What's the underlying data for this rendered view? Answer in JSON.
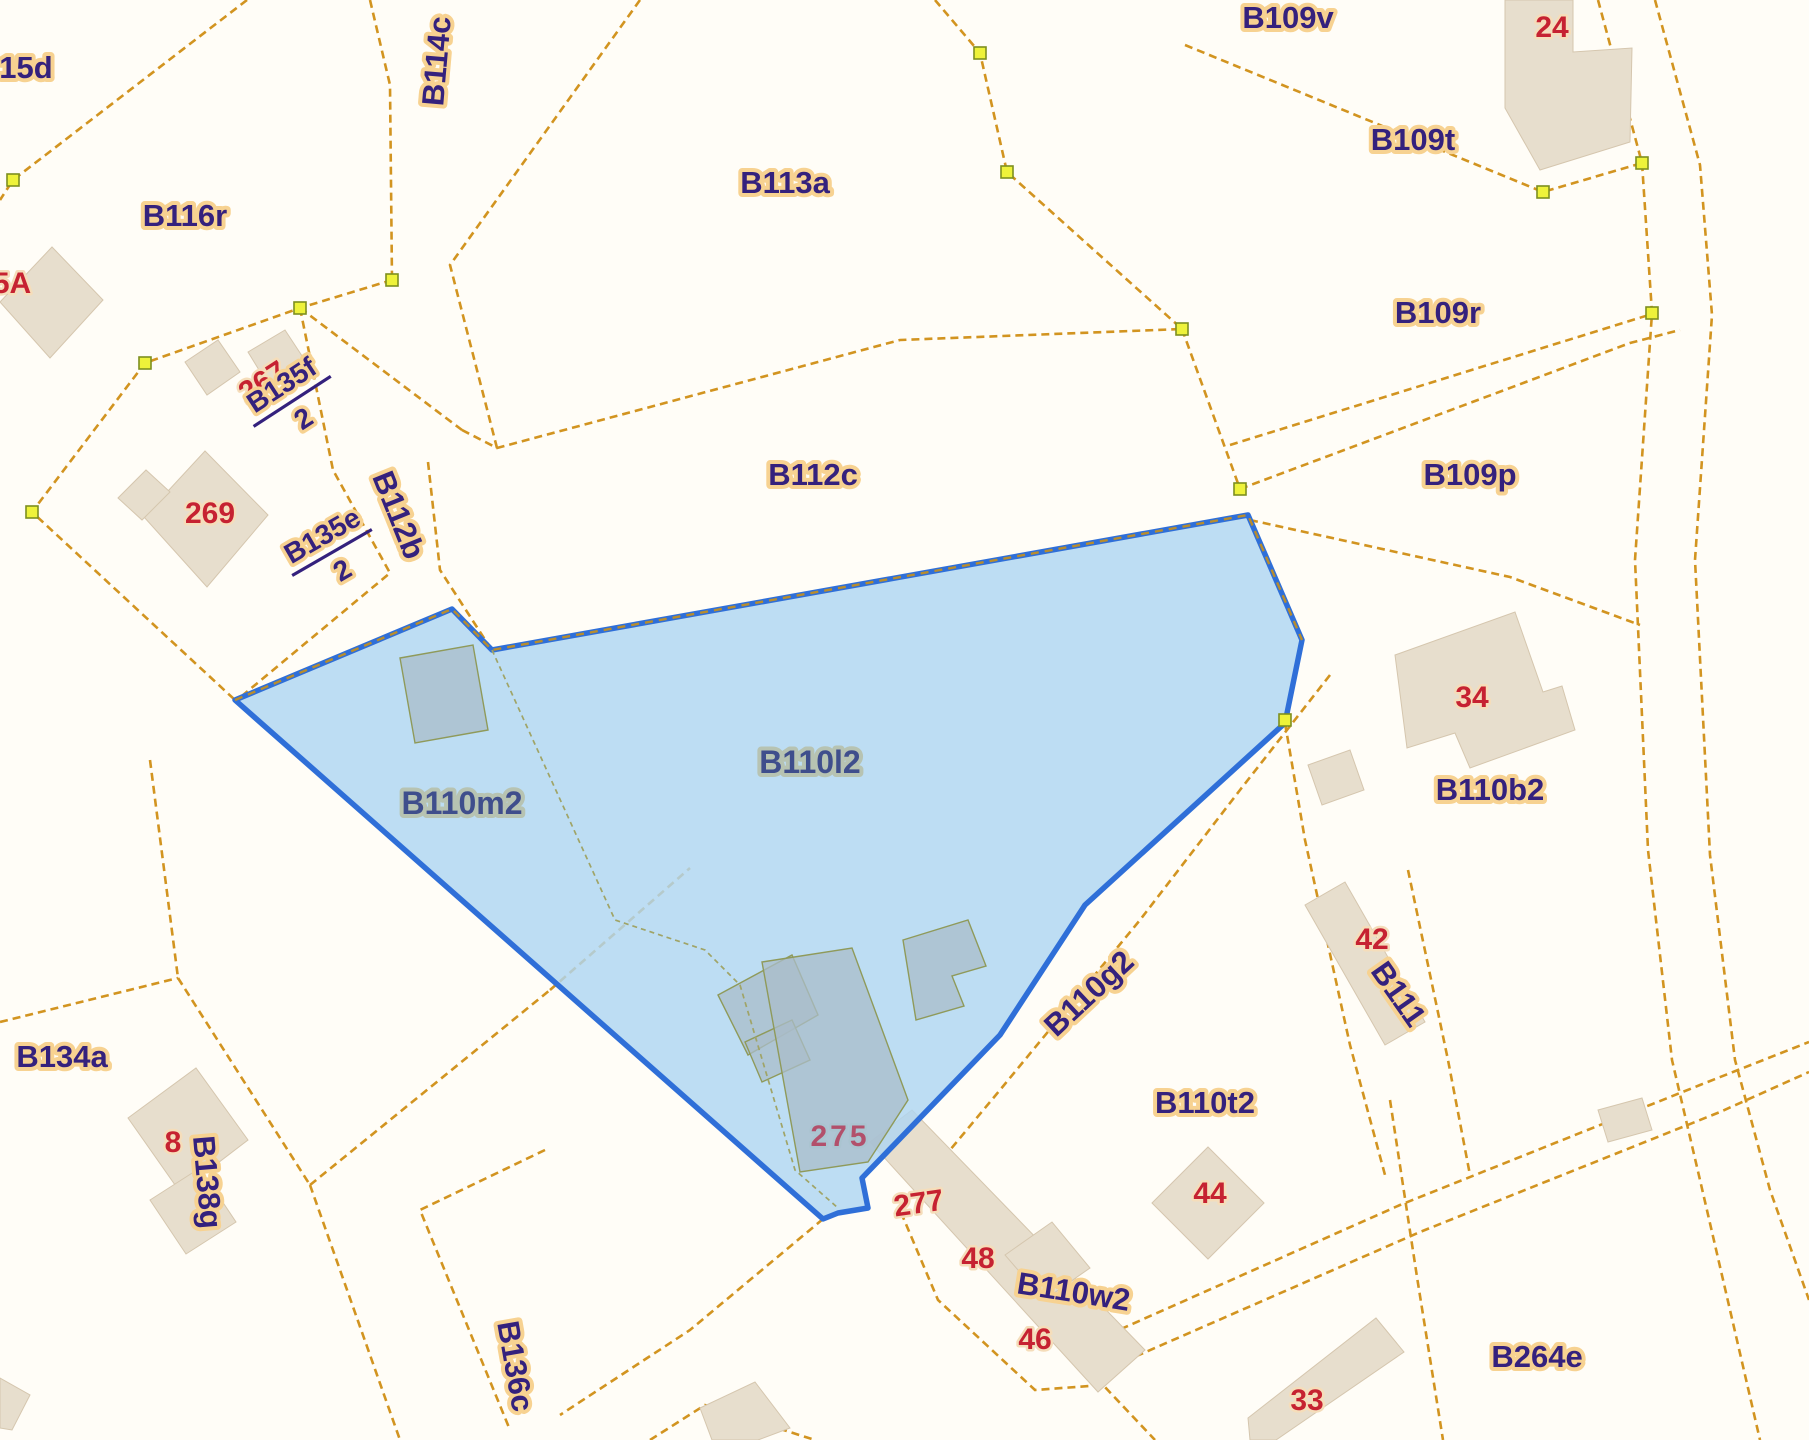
{
  "map": {
    "type": "cadastral-parcel-map",
    "selected_parcels": [
      "B110m2",
      "B110l2"
    ],
    "colors": {
      "background": "#fffdf7",
      "boundary_line": "#d29420",
      "parcel_label": "#34217d",
      "parcel_label_halo": "#f7d291",
      "house_number": "#c62231",
      "selection_fill": "#aed5f2",
      "selection_border": "#2f6fd8",
      "building_fill": "#e7decd",
      "vertex_marker": "#eef23a"
    },
    "parcel_labels": [
      {
        "id": "parcel-15d",
        "text": "15d",
        "x": 26,
        "y": 78,
        "rot": 0,
        "selected": false
      },
      {
        "id": "parcel-B116r",
        "text": "B116r",
        "x": 185,
        "y": 226,
        "rot": 0,
        "selected": false
      },
      {
        "id": "parcel-B114c",
        "text": "B114c",
        "x": 447,
        "y": 62,
        "rot": -85,
        "selected": false
      },
      {
        "id": "parcel-B113a",
        "text": "B113a",
        "x": 785,
        "y": 193,
        "rot": 0,
        "selected": false
      },
      {
        "id": "parcel-B109v",
        "text": "B109v",
        "x": 1288,
        "y": 28,
        "rot": 0,
        "selected": false
      },
      {
        "id": "parcel-B109t",
        "text": "B109t",
        "x": 1413,
        "y": 150,
        "rot": 0,
        "selected": false
      },
      {
        "id": "parcel-B109r",
        "text": "B109r",
        "x": 1438,
        "y": 323,
        "rot": 0,
        "selected": false
      },
      {
        "id": "parcel-B112c",
        "text": "B112c",
        "x": 813,
        "y": 485,
        "rot": 0,
        "selected": false
      },
      {
        "id": "parcel-B109p",
        "text": "B109p",
        "x": 1470,
        "y": 485,
        "rot": 0,
        "selected": false
      },
      {
        "id": "parcel-B112b",
        "text": "B112b",
        "x": 389,
        "y": 519,
        "rot": 68,
        "selected": false
      },
      {
        "id": "parcel-B110m2",
        "text": "B110m2",
        "x": 462,
        "y": 814,
        "rot": 0,
        "selected": true
      },
      {
        "id": "parcel-B110l2",
        "text": "B110l2",
        "x": 810,
        "y": 773,
        "rot": 0,
        "selected": true
      },
      {
        "id": "parcel-B110b2",
        "text": "B110b2",
        "x": 1490,
        "y": 800,
        "rot": 0,
        "selected": false
      },
      {
        "id": "parcel-B111",
        "text": "B111",
        "x": 1390,
        "y": 1000,
        "rot": 55,
        "selected": false
      },
      {
        "id": "parcel-B110g2",
        "text": "B110g2",
        "x": 1096,
        "y": 1001,
        "rot": -43,
        "selected": false
      },
      {
        "id": "parcel-B110t2",
        "text": "B110t2",
        "x": 1205,
        "y": 1113,
        "rot": 0,
        "selected": false
      },
      {
        "id": "parcel-B110w2",
        "text": "B110w2",
        "x": 1072,
        "y": 1302,
        "rot": 9,
        "selected": false
      },
      {
        "id": "parcel-B134a",
        "text": "B134a",
        "x": 62,
        "y": 1067,
        "rot": 0,
        "selected": false
      },
      {
        "id": "parcel-B138g",
        "text": "B138g",
        "x": 197,
        "y": 1183,
        "rot": 85,
        "selected": false
      },
      {
        "id": "parcel-B136c",
        "text": "B136c",
        "x": 505,
        "y": 1368,
        "rot": 80,
        "selected": false
      },
      {
        "id": "parcel-B264e",
        "text": "B264e",
        "x": 1537,
        "y": 1367,
        "rot": 0,
        "selected": false
      }
    ],
    "fraction_labels": [
      {
        "id": "parcel-B135f-2",
        "numerator": "B135f",
        "denominator": "2",
        "x": 290,
        "y": 398,
        "rot": -33
      },
      {
        "id": "parcel-B135e-2",
        "numerator": "B135e",
        "denominator": "2",
        "x": 330,
        "y": 549,
        "rot": -30
      }
    ],
    "house_numbers": [
      {
        "id": "house-24",
        "text": "24",
        "x": 1552,
        "y": 37,
        "rot": 0,
        "selected": false
      },
      {
        "id": "house-5A",
        "text": "5A",
        "x": 12,
        "y": 293,
        "rot": 0,
        "selected": false
      },
      {
        "id": "house-267",
        "text": "267",
        "x": 268,
        "y": 390,
        "rot": -33,
        "selected": false
      },
      {
        "id": "house-269",
        "text": "269",
        "x": 210,
        "y": 523,
        "rot": 0,
        "selected": false
      },
      {
        "id": "house-34",
        "text": "34",
        "x": 1472,
        "y": 707,
        "rot": 0,
        "selected": false
      },
      {
        "id": "house-42",
        "text": "42",
        "x": 1372,
        "y": 949,
        "rot": 0,
        "selected": false
      },
      {
        "id": "house-44",
        "text": "44",
        "x": 1210,
        "y": 1203,
        "rot": 0,
        "selected": false
      },
      {
        "id": "house-275",
        "text": "275",
        "x": 840,
        "y": 1146,
        "rot": 0,
        "selected": true
      },
      {
        "id": "house-277",
        "text": "277",
        "x": 920,
        "y": 1213,
        "rot": -8,
        "selected": false
      },
      {
        "id": "house-48",
        "text": "48",
        "x": 978,
        "y": 1268,
        "rot": 0,
        "selected": false
      },
      {
        "id": "house-46",
        "text": "46",
        "x": 1035,
        "y": 1349,
        "rot": 0,
        "selected": false
      },
      {
        "id": "house-33",
        "text": "33",
        "x": 1307,
        "y": 1410,
        "rot": 0,
        "selected": false
      },
      {
        "id": "house-8",
        "text": "8",
        "x": 173,
        "y": 1152,
        "rot": 0,
        "selected": false
      }
    ],
    "vertex_markers": [
      [
        13,
        180
      ],
      [
        300,
        308
      ],
      [
        392,
        280
      ],
      [
        145,
        363
      ],
      [
        32,
        512
      ],
      [
        980,
        53
      ],
      [
        1007,
        172
      ],
      [
        1182,
        329
      ],
      [
        1240,
        489
      ],
      [
        1543,
        192
      ],
      [
        1642,
        163
      ],
      [
        1652,
        313
      ],
      [
        1285,
        720
      ]
    ]
  }
}
